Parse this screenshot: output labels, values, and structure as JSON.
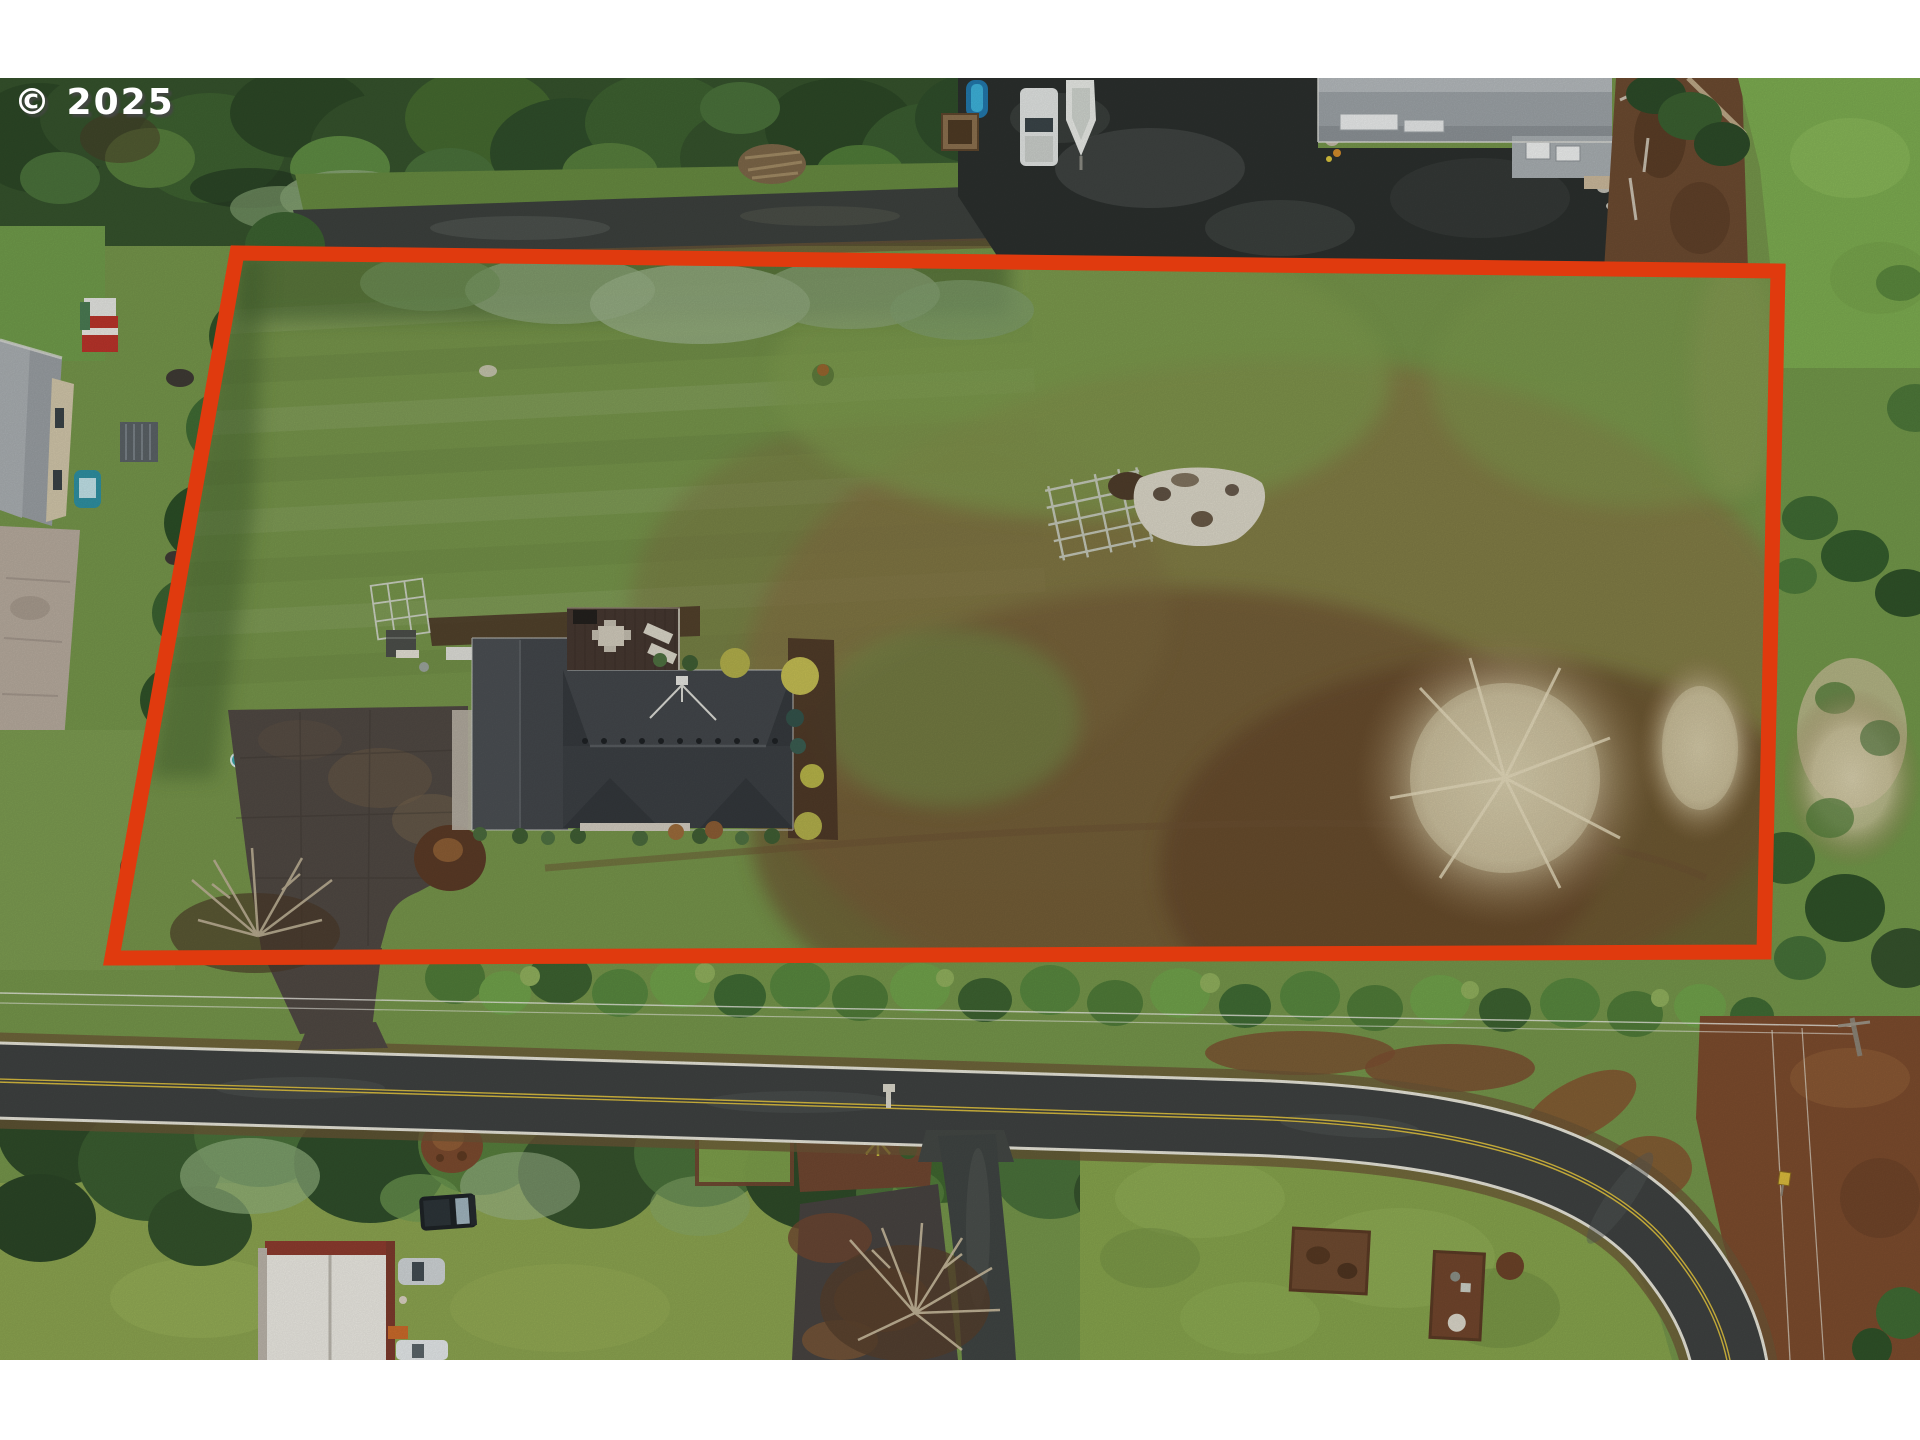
{
  "watermark": {
    "text": "© 2025"
  },
  "colors": {
    "boundary_red": "#e03a0e",
    "letterbox_white": "#ffffff",
    "road_centerline_yellow": "#d4b83e",
    "road_asphalt": "#3e4140",
    "lawn_green": "#74944a",
    "field_brown": "#6b4a2e",
    "roof_charcoal": "#3b3f43"
  },
  "boundary": {
    "label": "highlighted property lot line",
    "points": "237,175 1778,193 1764,874 112,880"
  },
  "photo": {
    "description": "Overhead aerial drone photo of a rural lot outlined in red-orange: dark-roofed house with deck and asphalt driveway on a large lawn, garden trellis and brush pile in a browning field, bare winter trees, perimeter hedges, neighboring homes, parked cars, RV, boat and barn, and a two-lane road with a double yellow centerline curving along the bottom."
  }
}
